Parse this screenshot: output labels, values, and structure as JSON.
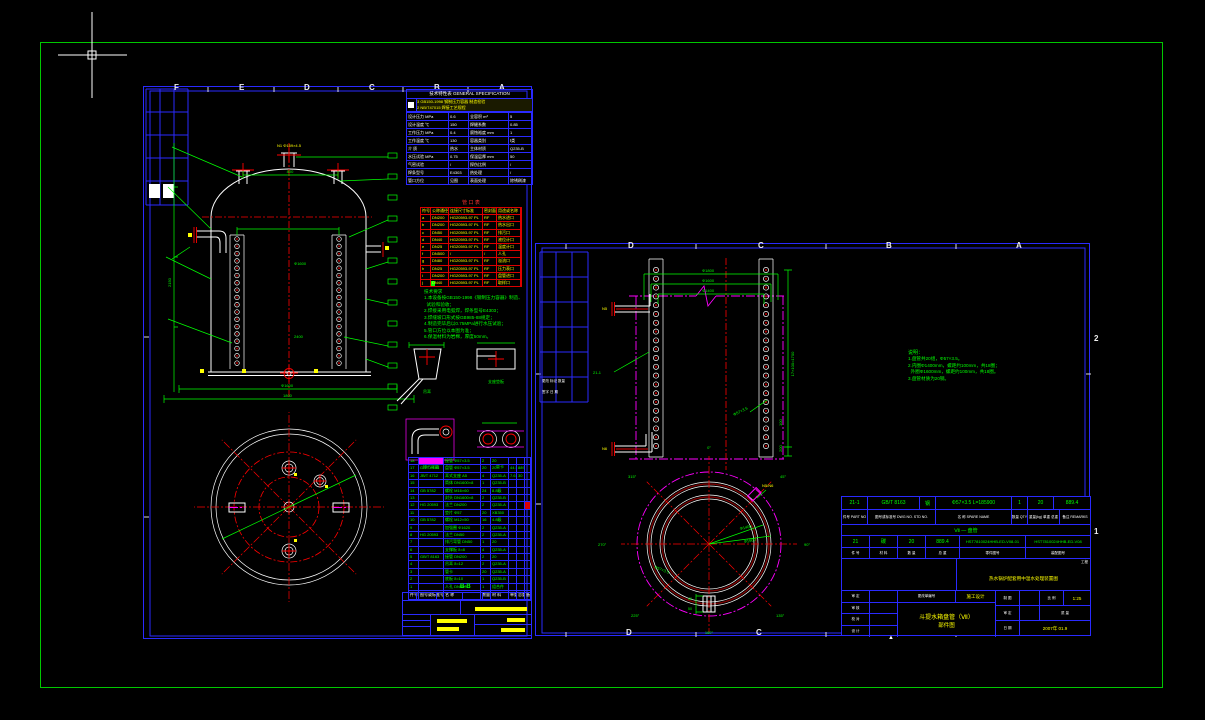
{
  "canvas": {
    "bg": "#000000",
    "border_color": "#00c800",
    "sheet_line_color": "#2a2aff",
    "cursor": "crosshair"
  },
  "left_sheet": {
    "zone_letters_top": [
      "F",
      "E",
      "D",
      "C",
      "B",
      "A"
    ],
    "spec_table": {
      "title": "技术特性表  GENERAL SPECIFICATION",
      "revision_lines": [
        "3  GB150-1998 钢制压力容器 制造检验",
        "2  NB/T47015 焊接工艺规程"
      ],
      "rows": [
        [
          "设计压力 MPa",
          "0.6",
          "全容积 m³",
          "5"
        ],
        [
          "设计温度 ℃",
          "150",
          "焊缝系数",
          "0.85"
        ],
        [
          "工作压力 MPa",
          "0.4",
          "腐蚀裕度 mm",
          "1"
        ],
        [
          "工作温度 ℃",
          "130",
          "容器类别",
          "Ⅰ类"
        ],
        [
          "介  质",
          "热水",
          "主体材质",
          "Q235-B"
        ],
        [
          "水压试验 MPa",
          "0.75",
          "保温层厚 mm",
          "50"
        ],
        [
          "气密试验",
          "/",
          "探伤比例",
          "/"
        ],
        [
          "焊条型号",
          "E4303",
          "热处理",
          "/"
        ],
        [
          "管口方位",
          "见图",
          "表面处理",
          "除锈刷漆"
        ]
      ]
    },
    "nozzle_table": {
      "title": "管  口  表",
      "rows": [
        [
          "符号",
          "公称通径",
          "连接尺寸标准",
          "密封面",
          "用途或名称"
        ],
        [
          "a",
          "DN200",
          "HG20593-97 PL",
          "RF",
          "热水进口"
        ],
        [
          "b",
          "DN200",
          "HG20593-97 PL",
          "RF",
          "热水出口"
        ],
        [
          "c",
          "DN50",
          "HG20593-97 PL",
          "RF",
          "排污口"
        ],
        [
          "d",
          "DN40",
          "HG20593-97 PL",
          "RF",
          "液位计口"
        ],
        [
          "e",
          "DN25",
          "HG20593-97 PL",
          "RF",
          "温度计口"
        ],
        [
          "f",
          "DN500",
          "/",
          "/",
          "人孔"
        ],
        [
          "g",
          "DN80",
          "HG20593-97 PL",
          "RF",
          "溢流口"
        ],
        [
          "h",
          "DN25",
          "HG20593-97 PL",
          "RF",
          "压力表口"
        ],
        [
          "i",
          "DN200",
          "HG20593-97 PL",
          "RF",
          "盘管进口"
        ],
        [
          "j",
          "DN40",
          "HG20593-97 PL",
          "RF",
          "取样口"
        ]
      ]
    },
    "notes": {
      "title": "技术要求",
      "lines": [
        "1.本设备按GB150-1998《钢制压力容器》制造、",
        "  试验和验收；",
        "2.焊接采用电弧焊，焊条型号E4303；",
        "3.焊缝坡口形式按GB985-88规定；",
        "4.制造完毕后以0.75MPa进行水压试验；",
        "5.管口方位以本图为准；",
        "6.保温材料为岩棉，厚度50mm。"
      ]
    },
    "details": {
      "labels": [
        "吊耳",
        "支座垫板",
        "排污弯管",
        "管卡"
      ]
    },
    "bom": {
      "section_label": "B-B",
      "rows": [
        [
          "18",
          "",
          "接管 Φ57×3.5",
          "2",
          "20",
          "",
          "",
          ""
        ],
        [
          "17",
          "GB/T 8163",
          "盘管 Φ57×3.5",
          "20",
          "20",
          "44.5",
          "889",
          ""
        ],
        [
          "16",
          "JB/T 4712",
          "耳式支座 A5",
          "4",
          "Q235-A",
          "7.6",
          "30",
          ""
        ],
        [
          "15",
          "",
          "筒体 DN1600×8",
          "1",
          "Q235-B",
          "",
          "",
          ""
        ],
        [
          "14",
          "GB 5782",
          "螺栓 M16×60",
          "24",
          "8.8级",
          "",
          "",
          ""
        ],
        [
          "13",
          "",
          "封头 DN1600×8",
          "2",
          "Q235-B",
          "",
          "",
          ""
        ],
        [
          "12",
          "HG 20593",
          "法兰 DN200",
          "2",
          "Q235-A",
          "",
          "",
          ""
        ],
        [
          "11",
          "",
          "垫片 Φ57",
          "20",
          "XB350",
          "",
          "",
          ""
        ],
        [
          "10",
          "GB 5782",
          "螺栓 M12×50",
          "16",
          "4.8级",
          "",
          "",
          ""
        ],
        [
          "9",
          "",
          "加强圈 Φ1620",
          "2",
          "Q235-A",
          "",
          "",
          ""
        ],
        [
          "8",
          "HG 20593",
          "法兰 DN50",
          "2",
          "Q235-A",
          "",
          "",
          ""
        ],
        [
          "7",
          "",
          "排污弯管 DN50",
          "1",
          "20",
          "",
          "",
          ""
        ],
        [
          "6",
          "",
          "支撑板 δ=8",
          "4",
          "Q235-A",
          "",
          "",
          ""
        ],
        [
          "5",
          "GB/T 8163",
          "接管 DN200",
          "2",
          "20",
          "",
          "",
          ""
        ],
        [
          "4",
          "",
          "吊耳 δ=12",
          "2",
          "Q235-A",
          "",
          "",
          ""
        ],
        [
          "3",
          "",
          "管卡",
          "20",
          "Q235-A",
          "",
          "",
          ""
        ],
        [
          "2",
          "",
          "底板 δ=10",
          "1",
          "Q235-B",
          "",
          "",
          ""
        ],
        [
          "1",
          "",
          "人孔 DN500",
          "1",
          "组合件",
          "",
          "",
          ""
        ],
        [
          "件号",
          "图号或标准号",
          "名 称",
          "数量",
          "材 料",
          "单重",
          "总重",
          "备"
        ]
      ]
    },
    "vessel": {
      "n1_label": "N1 Φ159×4.5",
      "dim_top": "800",
      "dim_shell": "Φ1600",
      "dim_height": "2400",
      "dim_width": "Φ1600",
      "dim_width2": "1800",
      "dim_left": "2150"
    }
  },
  "right_sheet": {
    "zone_letters": [
      "D",
      "C",
      "B",
      "A"
    ],
    "zone_numbers": [
      "2",
      "1"
    ],
    "rev_block_lines": [
      "更改 标记 数量",
      "签字  日 期"
    ],
    "coil": {
      "part_label": "21-1",
      "n5": "N5",
      "n6": "N6",
      "dia_dims": [
        "Φ1800",
        "Φ1600",
        "Φ1400"
      ],
      "pitch_dim": "17×100=1700",
      "dim_100": "100",
      "dim_200": "200",
      "pipe_label": "Φ57×3.5"
    },
    "notes": {
      "title": "说明：",
      "lines": [
        "1.盘管共20组，Φ57×3.5。",
        "2.内圈Φ1400mm，螺距约100mm，共18圈；",
        "  外圈Φ1600mm，螺距约100mm，共18圈。",
        "3.盘管材质为20钢。"
      ]
    },
    "circle_view": {
      "angles": [
        "0°",
        "45°",
        "90°",
        "135°",
        "180°",
        "225°",
        "270°",
        "315°"
      ],
      "nozzle_label": "N5/N6",
      "dim_inner": "Φ1400",
      "dim_outer": "Φ1600",
      "dim_pipe": "Φ57×3.5",
      "dim_40": "40",
      "dim_50": "50"
    },
    "title_block": {
      "part_row": [
        "21-1",
        "GB/T 8163",
        "钢",
        "Φ57×3.5  L=185900",
        "1",
        "20",
        "889.4"
      ],
      "part_labels": [
        "件号\nPART NO",
        "图号或标准号\nDWG NO. STD NO.",
        "名 称\nSPARE NAME",
        "数量\nQTY",
        "重量(kg)\n单重 总重",
        "备注\nREMARKS"
      ],
      "assembly_name": "Ⅶ — 盘管",
      "detail_row": [
        "21",
        "碳",
        "20",
        "889.4",
        "HST7810024HHB-ED-V08-01",
        "HST7810024HHB-ED-V08"
      ],
      "detail_labels": [
        "件 号",
        "材 料",
        "数 量",
        "总 重",
        "零件图号",
        "装配图号"
      ],
      "project_label": "工程",
      "project_name": "热水锅炉配套用中温水处理装置图",
      "sign_labels": [
        "审 定",
        "审 核",
        "校 对",
        "设 计"
      ],
      "change_label": "更改单编号",
      "stage": "施工设计",
      "drawing_title": "斗提水箱盘管（Ⅶ）",
      "drawing_subtitle": "部件图",
      "scale_label": "比 例",
      "scale_value": "1:25",
      "draw_label": "制 图",
      "check_label": "审 定",
      "mass_label": "质 量",
      "date_label": "日 期",
      "date_value": "2007年 01.9"
    }
  }
}
